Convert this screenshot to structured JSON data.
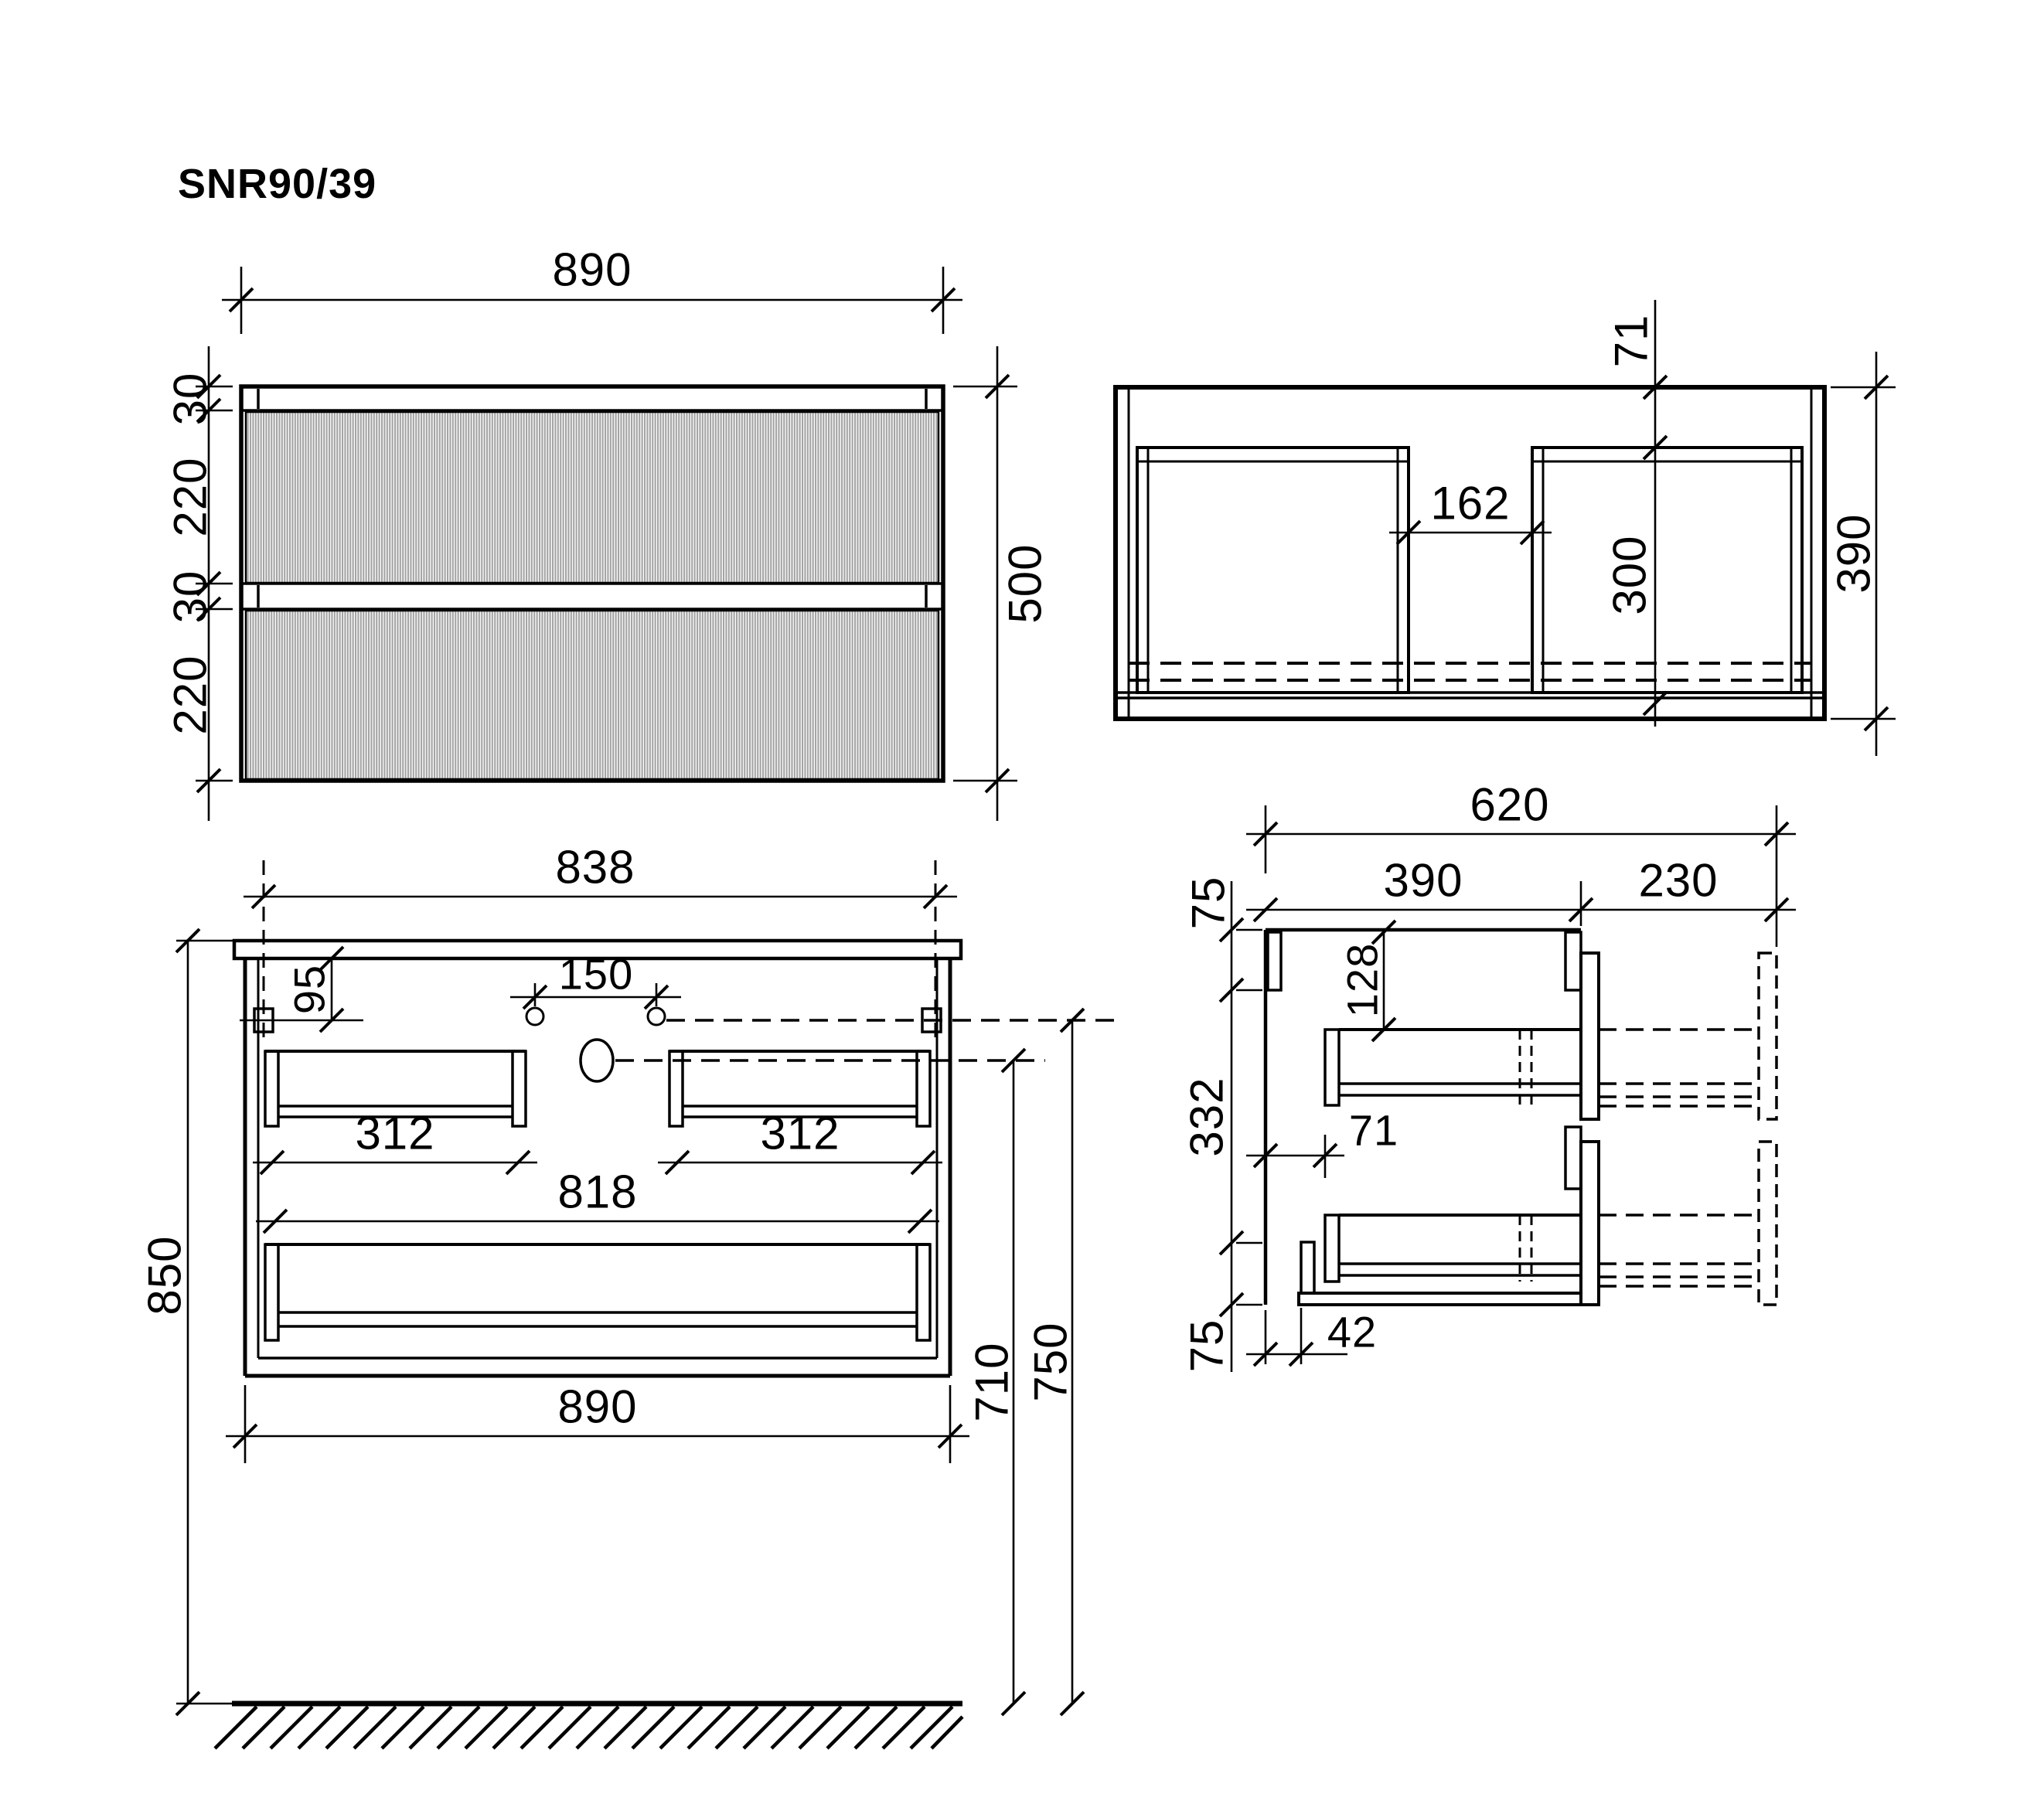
{
  "title": "SNR90/39",
  "front_view": {
    "dims": {
      "width_top": "890",
      "height_right": "500",
      "left_chain": [
        "30",
        "220",
        "30",
        "220"
      ]
    }
  },
  "plan_view": {
    "dims": {
      "back_offset": "71",
      "cutout_gap": "162",
      "cutout_depth": "300",
      "total_depth": "390"
    }
  },
  "bottom_front_view": {
    "dims": {
      "bracket_span": "838",
      "bracket_drop": "95",
      "faucet_spacing": "150",
      "drawer_inner_left": "312",
      "drawer_inner_right": "312",
      "bottom_inner_width": "818",
      "total_width": "890",
      "countertop_to_floor": "850",
      "drain_to_floor": "710",
      "bracket_to_floor": "750"
    }
  },
  "side_view": {
    "dims": {
      "extended_depth": "620",
      "cabinet_depth": "390",
      "drawer_extension": "230",
      "top_rail_height": "75",
      "middle_span": "332",
      "bottom_rail_height": "75",
      "drawer_top_offset": "128",
      "back_clearance": "71",
      "bottom_back_offset": "42"
    }
  },
  "colors": {
    "line": "#000000",
    "flute_stripe": "#a3a3a3",
    "background": "#ffffff"
  }
}
